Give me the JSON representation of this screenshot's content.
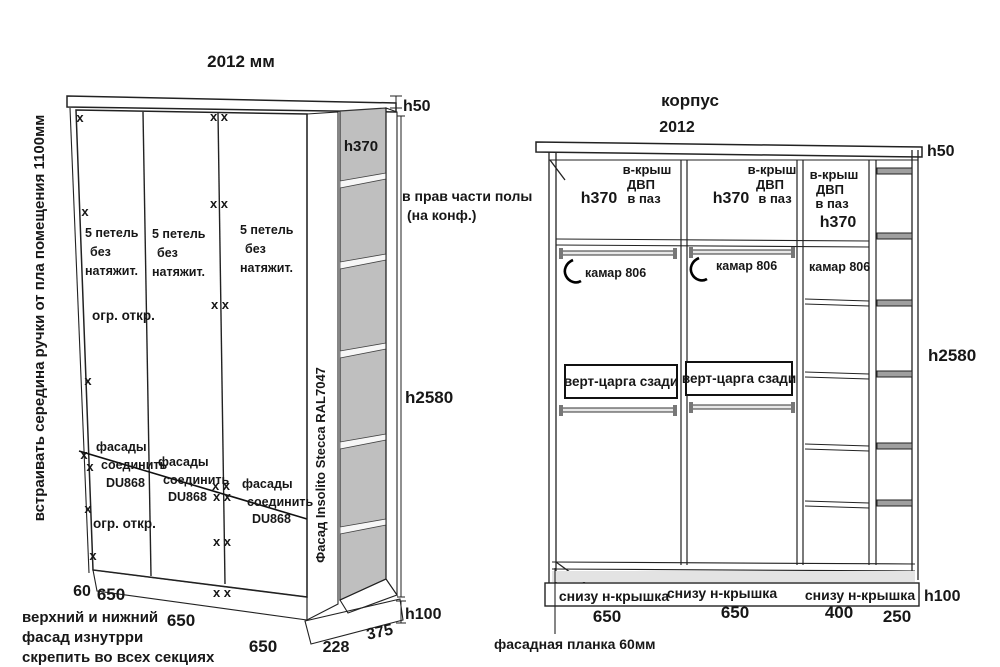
{
  "colors": {
    "line": "#222222",
    "door_gray": "#c9c9c9",
    "cap_gray": "#dcdcdc",
    "interior_gray": "#bfbfbf",
    "shelf_front_gray": "#9f9f9f",
    "background": "#ffffff"
  },
  "glyphs": {
    "x_mark": "x",
    "x_pair": "x x"
  },
  "left_view": {
    "width_label": "2012 мм",
    "side_note": "встраивать  середина ручки  от пла  помещения  1100мм",
    "h50": "h50",
    "h370": "h370",
    "h2580": "h2580",
    "h100": "h100",
    "right_note": [
      "в прав части полы",
      "(на конф.)"
    ],
    "hinges": [
      "5 петель",
      "без",
      "натяжит."
    ],
    "limiter": "огр. откр.",
    "join": [
      "фасады",
      "соединить",
      "DU868"
    ],
    "stile_label": "Фасад Insolito Stecca RAL7047",
    "dims": {
      "d60": "60",
      "d650": "650",
      "d228": "228",
      "d375": "375"
    },
    "bottom_note": [
      "верхний и нижний",
      "фасад изнутрри",
      "скрепить во всех секциях"
    ]
  },
  "right_view": {
    "title": "корпус",
    "width_label": "2012",
    "h50": "h50",
    "h2580": "h2580",
    "h100": "h100",
    "top_label": [
      "в-крыш",
      "ДВП",
      "в паз"
    ],
    "h370": "h370",
    "rod_label": "камар 806",
    "crossbar_label": "верт-царга сзади",
    "plinth_label": "снизу н-крышка",
    "dims": [
      "650",
      "650",
      "400",
      "250"
    ],
    "bottom_note": "фасадная планка 60мм"
  }
}
